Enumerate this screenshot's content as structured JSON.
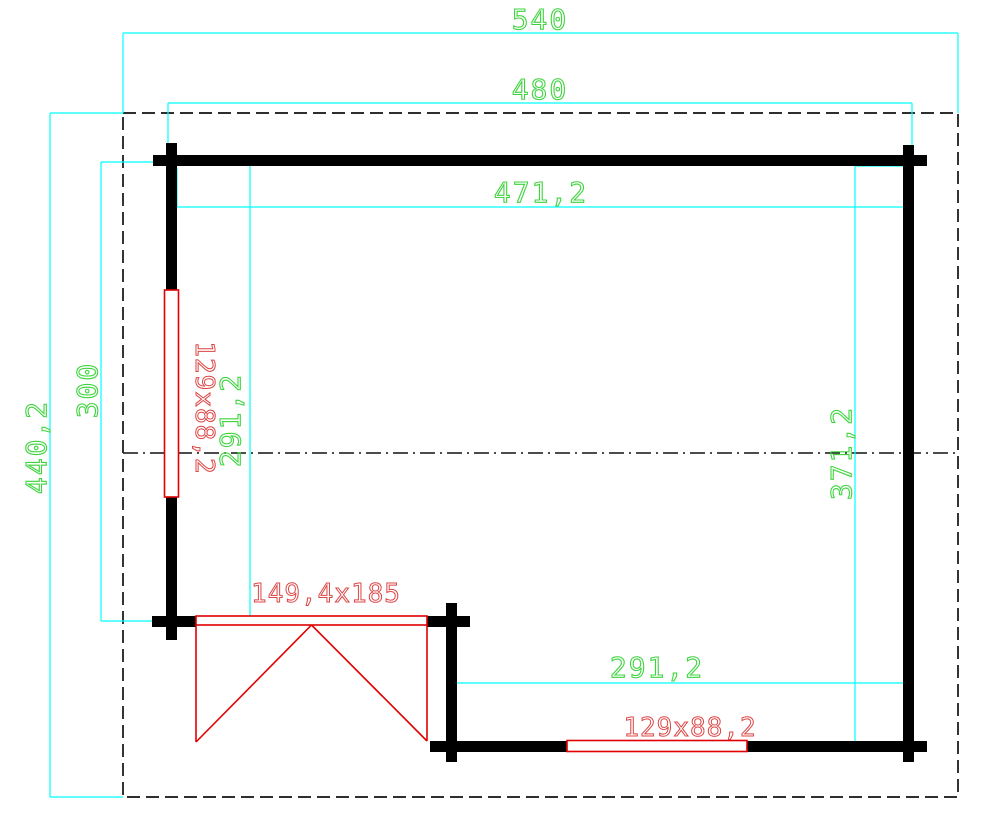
{
  "drawing": {
    "type": "floor-plan",
    "dimensions": {
      "overall_width": "540",
      "outer_wall_width": "480",
      "interior_width": "471,2",
      "overall_depth": "440,2",
      "left_wall_length": "300",
      "left_interior_depth": "291,2",
      "right_interior_depth": "371,2",
      "bottom_interior_width": "291,2"
    },
    "openings": {
      "door_size": "149,4x185",
      "window_left_size": "129x88,2",
      "window_bottom_size": "129x88,2"
    },
    "colors": {
      "dimension_line": "#00ffff",
      "dimension_text": "#3fd43f",
      "opening_line": "#e00000",
      "opening_text": "#dd4545",
      "wall": "#000000",
      "overhang_dash": "#101010",
      "background": "#ffffff"
    }
  }
}
